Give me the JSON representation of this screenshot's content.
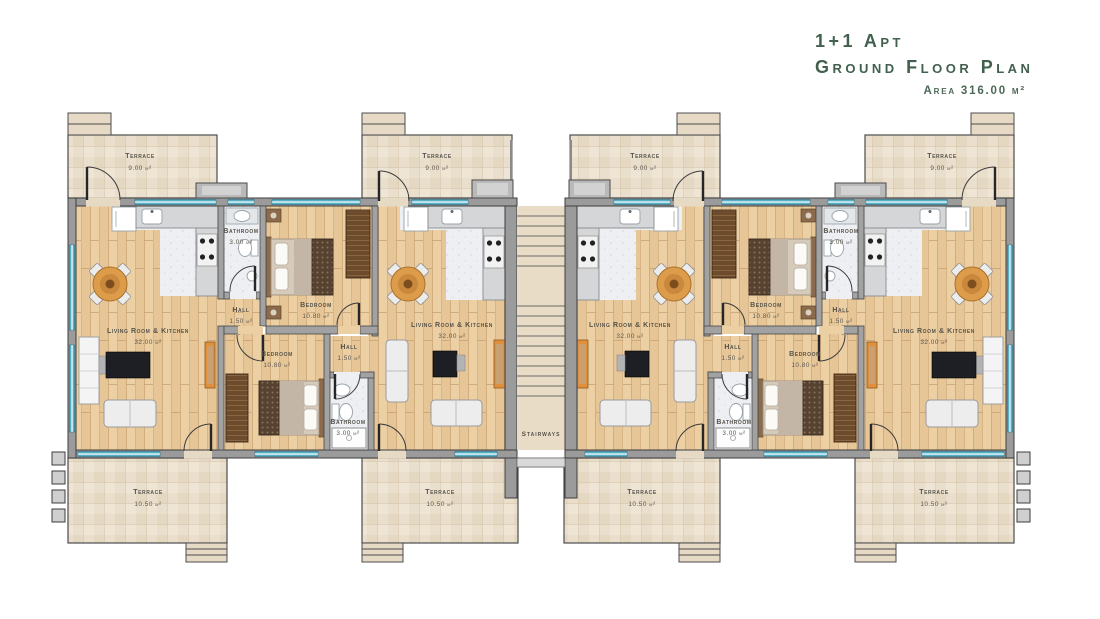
{
  "title": {
    "line1": "1+1 Apt",
    "line2": "Ground Floor Plan",
    "line3": "Area 316.00 m²"
  },
  "rooms": {
    "living": {
      "name": "Living Room & Kitchen",
      "area": "32.00 m²"
    },
    "bedroom": {
      "name": "Bedroom",
      "area": "10.80 m²"
    },
    "bathroom": {
      "name": "Bathroom",
      "area": "3.00 m²"
    },
    "hall": {
      "name": "Hall",
      "area": "1.50 m²"
    },
    "terrace_front": {
      "name": "Terrace",
      "area": "9.00 m²"
    },
    "terrace_back": {
      "name": "Terrace",
      "area": "10.50 m²"
    },
    "stairways": {
      "name": "Stairways"
    }
  },
  "colors": {
    "title_text": "#41604d",
    "wall_gray": "#9b9b9b",
    "window_teal": "#57b0c6",
    "wood_floor": "#ecd0a4",
    "terrace_tile": "#eadfcd",
    "accent_orange": "#e0903c"
  }
}
